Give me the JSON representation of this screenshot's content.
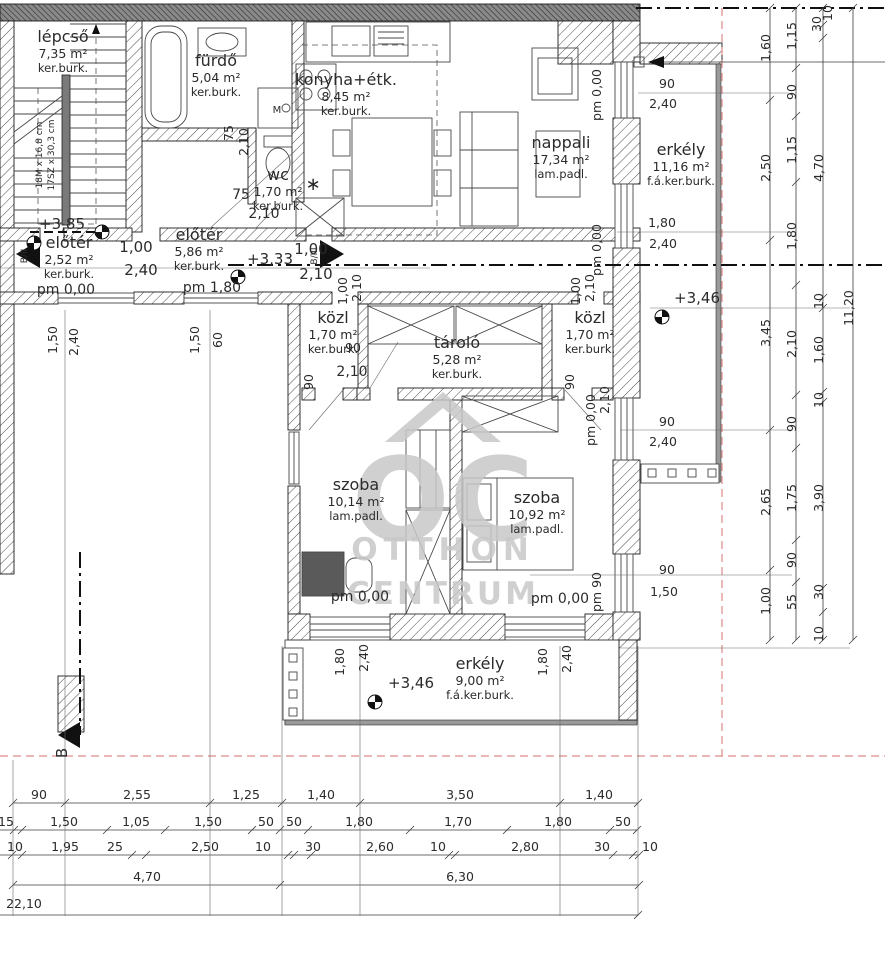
{
  "watermark": {
    "monogram": "OC",
    "line1": "OTTHON",
    "line2": "CENTRUM"
  },
  "section_marks": {
    "bottom": "B",
    "left": "B/II",
    "right": "B/III"
  },
  "stair_note": {
    "risers": "18M x 16,8 cm",
    "treads": "17SZ x 30,3 cm"
  },
  "colors": {
    "wall": "#1b1b1b",
    "hatch": "#4a4a4a",
    "top_band": "#8a8a8a",
    "red_dash": "#dd8a8a",
    "watermark": "#c8c8c8"
  },
  "rooms": [
    {
      "name": "lépcső",
      "area": "7,35 m²",
      "floor": "ker.burk.",
      "x": 63,
      "y": 42
    },
    {
      "name": "fürdő",
      "area": "5,04 m²",
      "floor": "ker.burk.",
      "x": 216,
      "y": 66
    },
    {
      "name": "wc",
      "area": "1,70 m²",
      "floor": "ker.burk.",
      "x": 278,
      "y": 180
    },
    {
      "name": "konyha+étk.",
      "area": "8,45 m²",
      "floor": "ker.burk.",
      "x": 346,
      "y": 85
    },
    {
      "name": "nappali",
      "area": "17,34 m²",
      "floor": "lam.padl.",
      "x": 561,
      "y": 148
    },
    {
      "name": "erkély",
      "area": "11,16 m²",
      "floor": "f.á.ker.burk.",
      "x": 681,
      "y": 155
    },
    {
      "name": "előtér",
      "area": "5,86 m²",
      "floor": "ker.burk.",
      "x": 199,
      "y": 240
    },
    {
      "name": "előtér",
      "area": "2,52 m²",
      "floor": "ker.burk.",
      "x": 69,
      "y": 248
    },
    {
      "name": "közl",
      "area": "1,70 m²",
      "floor": "ker.burk.",
      "x": 333,
      "y": 323
    },
    {
      "name": "tároló",
      "area": "5,28 m²",
      "floor": "ker.burk.",
      "x": 457,
      "y": 348
    },
    {
      "name": "közl",
      "area": "1,70 m²",
      "floor": "ker.burk.",
      "x": 590,
      "y": 323
    },
    {
      "name": "szoba",
      "area": "10,14 m²",
      "floor": "lam.padl.",
      "x": 356,
      "y": 490
    },
    {
      "name": "szoba",
      "area": "10,92 m²",
      "floor": "lam.padl.",
      "x": 537,
      "y": 503
    },
    {
      "name": "erkély",
      "area": "9,00 m²",
      "floor": "f.á.ker.burk.",
      "x": 480,
      "y": 669
    }
  ],
  "dim_labels": [
    {
      "t": "1,60",
      "x": 770,
      "y": 48,
      "r": -90
    },
    {
      "t": "2,50",
      "x": 770,
      "y": 168,
      "r": -90
    },
    {
      "t": "3,45",
      "x": 770,
      "y": 333,
      "r": -90
    },
    {
      "t": "2,65",
      "x": 770,
      "y": 502,
      "r": -90
    },
    {
      "t": "1,00",
      "x": 770,
      "y": 601,
      "r": -90
    },
    {
      "t": "1,15",
      "x": 796,
      "y": 36,
      "r": -90
    },
    {
      "t": "90",
      "x": 796,
      "y": 92,
      "r": -90
    },
    {
      "t": "1,15",
      "x": 796,
      "y": 150,
      "r": -90
    },
    {
      "t": "1,80",
      "x": 796,
      "y": 236,
      "r": -90
    },
    {
      "t": "2,10",
      "x": 796,
      "y": 344,
      "r": -90
    },
    {
      "t": "90",
      "x": 796,
      "y": 424,
      "r": -90
    },
    {
      "t": "1,75",
      "x": 796,
      "y": 498,
      "r": -90
    },
    {
      "t": "90",
      "x": 796,
      "y": 560,
      "r": -90
    },
    {
      "t": "55",
      "x": 796,
      "y": 602,
      "r": -90
    },
    {
      "t": "30",
      "x": 821,
      "y": 24,
      "r": -90
    },
    {
      "t": "10",
      "x": 832,
      "y": 13,
      "r": -90
    },
    {
      "t": "4,70",
      "x": 823,
      "y": 168,
      "r": -90
    },
    {
      "t": "10",
      "x": 823,
      "y": 301,
      "r": -90
    },
    {
      "t": "1,60",
      "x": 823,
      "y": 350,
      "r": -90
    },
    {
      "t": "10",
      "x": 823,
      "y": 400,
      "r": -90
    },
    {
      "t": "3,90",
      "x": 823,
      "y": 498,
      "r": -90
    },
    {
      "t": "30",
      "x": 823,
      "y": 592,
      "r": -90
    },
    {
      "t": "10",
      "x": 823,
      "y": 634,
      "r": -90
    },
    {
      "t": "11,20",
      "x": 853,
      "y": 308,
      "r": -90
    },
    {
      "t": "pm 0,00",
      "x": 601,
      "y": 95,
      "r": -90
    },
    {
      "t": "pm 0,00",
      "x": 601,
      "y": 250,
      "r": -90
    },
    {
      "t": "1,00",
      "x": 580,
      "y": 291,
      "r": -90
    },
    {
      "t": "2,10",
      "x": 594,
      "y": 288,
      "r": -90
    },
    {
      "t": "1,00",
      "x": 347,
      "y": 291,
      "r": -90
    },
    {
      "t": "2,10",
      "x": 361,
      "y": 288,
      "r": -90
    },
    {
      "t": "pm 0,00",
      "x": 595,
      "y": 420,
      "r": -90
    },
    {
      "t": "2,10",
      "x": 609,
      "y": 400,
      "r": -90
    },
    {
      "t": "pm 90",
      "x": 601,
      "y": 592,
      "r": -90
    },
    {
      "t": "75",
      "x": 233,
      "y": 133,
      "r": -90
    },
    {
      "t": "2,10",
      "x": 248,
      "y": 142,
      "r": -90
    },
    {
      "t": "1,50",
      "x": 57,
      "y": 340,
      "r": -90
    },
    {
      "t": "2,40",
      "x": 78,
      "y": 342,
      "r": -90
    },
    {
      "t": "1,50",
      "x": 199,
      "y": 340,
      "r": -90
    },
    {
      "t": "60",
      "x": 222,
      "y": 340,
      "r": -90
    },
    {
      "t": "1,80",
      "x": 344,
      "y": 662,
      "r": -90
    },
    {
      "t": "2,40",
      "x": 368,
      "y": 658,
      "r": -90
    },
    {
      "t": "1,80",
      "x": 547,
      "y": 662,
      "r": -90
    },
    {
      "t": "2,40",
      "x": 571,
      "y": 659,
      "r": -90
    },
    {
      "t": "90",
      "x": 313,
      "y": 382,
      "r": -90
    },
    {
      "t": "90",
      "x": 574,
      "y": 382,
      "r": -90
    },
    {
      "t": "B",
      "x": 67,
      "y": 753,
      "r": -90,
      "s": 15
    },
    {
      "t": "B/II",
      "x": 27,
      "y": 256,
      "r": -90,
      "s": 9
    },
    {
      "t": "B/III",
      "x": 317,
      "y": 256,
      "r": -90,
      "s": 9
    },
    {
      "t": "18M x 16,8 cm",
      "x": 42,
      "y": 155,
      "r": -90,
      "s": 9
    },
    {
      "t": "17SZ x 30,3 cm",
      "x": 54,
      "y": 155,
      "r": -90,
      "s": 9
    },
    {
      "t": "90",
      "x": 667,
      "y": 88
    },
    {
      "t": "2,40",
      "x": 663,
      "y": 108
    },
    {
      "t": "1,80",
      "x": 662,
      "y": 227
    },
    {
      "t": "2,40",
      "x": 663,
      "y": 248
    },
    {
      "t": "90",
      "x": 667,
      "y": 426
    },
    {
      "t": "2,40",
      "x": 663,
      "y": 446
    },
    {
      "t": "90",
      "x": 667,
      "y": 574
    },
    {
      "t": "1,50",
      "x": 664,
      "y": 596
    },
    {
      "t": "+3,46",
      "x": 697,
      "y": 303,
      "s": 15
    },
    {
      "t": "+3,46",
      "x": 411,
      "y": 688,
      "s": 15
    },
    {
      "t": "+3,33",
      "x": 270,
      "y": 264,
      "s": 15
    },
    {
      "t": "+3,85",
      "x": 62,
      "y": 229,
      "s": 15
    },
    {
      "t": "pm 1,80",
      "x": 212,
      "y": 292,
      "s": 14
    },
    {
      "t": "pm 0,00",
      "x": 66,
      "y": 294,
      "s": 14
    },
    {
      "t": "pm 0,00",
      "x": 360,
      "y": 601,
      "s": 14
    },
    {
      "t": "pm 0,00",
      "x": 560,
      "y": 603,
      "s": 14
    },
    {
      "t": "1,00",
      "x": 136,
      "y": 252,
      "s": 15
    },
    {
      "t": "2,40",
      "x": 141,
      "y": 275,
      "s": 15
    },
    {
      "t": "1,00",
      "x": 311,
      "y": 254,
      "s": 15
    },
    {
      "t": "2,10",
      "x": 316,
      "y": 279,
      "s": 15
    },
    {
      "t": "75",
      "x": 241,
      "y": 199,
      "s": 14
    },
    {
      "t": "2,10",
      "x": 264,
      "y": 218,
      "s": 14
    },
    {
      "t": "90",
      "x": 353,
      "y": 352
    },
    {
      "t": "2,10",
      "x": 352,
      "y": 376,
      "s": 14
    },
    {
      "t": "M",
      "x": 277,
      "y": 113,
      "s": 10
    },
    {
      "t": "∗",
      "x": 313,
      "y": 190,
      "s": 18
    },
    {
      "t": "90",
      "x": 39,
      "y": 799
    },
    {
      "t": "2,55",
      "x": 137,
      "y": 799
    },
    {
      "t": "1,25",
      "x": 246,
      "y": 799
    },
    {
      "t": "1,40",
      "x": 321,
      "y": 799
    },
    {
      "t": "3,50",
      "x": 460,
      "y": 799
    },
    {
      "t": "1,40",
      "x": 599,
      "y": 799
    },
    {
      "t": "15",
      "x": 6,
      "y": 826
    },
    {
      "t": "1,50",
      "x": 64,
      "y": 826
    },
    {
      "t": "1,05",
      "x": 136,
      "y": 826
    },
    {
      "t": "1,50",
      "x": 208,
      "y": 826
    },
    {
      "t": "50",
      "x": 266,
      "y": 826
    },
    {
      "t": "50",
      "x": 294,
      "y": 826
    },
    {
      "t": "1,80",
      "x": 359,
      "y": 826
    },
    {
      "t": "1,70",
      "x": 458,
      "y": 826
    },
    {
      "t": "1,80",
      "x": 558,
      "y": 826
    },
    {
      "t": "50",
      "x": 623,
      "y": 826
    },
    {
      "t": "10",
      "x": 15,
      "y": 851
    },
    {
      "t": "1,95",
      "x": 65,
      "y": 851
    },
    {
      "t": "25",
      "x": 115,
      "y": 851
    },
    {
      "t": "2,50",
      "x": 205,
      "y": 851
    },
    {
      "t": "10",
      "x": 263,
      "y": 851
    },
    {
      "t": "30",
      "x": 313,
      "y": 851
    },
    {
      "t": "2,60",
      "x": 380,
      "y": 851
    },
    {
      "t": "10",
      "x": 438,
      "y": 851
    },
    {
      "t": "2,80",
      "x": 525,
      "y": 851
    },
    {
      "t": "30",
      "x": 602,
      "y": 851
    },
    {
      "t": "10",
      "x": 650,
      "y": 851
    },
    {
      "t": "4,70",
      "x": 147,
      "y": 881
    },
    {
      "t": "6,30",
      "x": 460,
      "y": 881
    },
    {
      "t": "22,10",
      "x": 24,
      "y": 908
    }
  ],
  "dims": {
    "vcols": [
      {
        "x": 770,
        "ticks": [
          8,
          100,
          240,
          430,
          570,
          640
        ]
      },
      {
        "x": 796,
        "ticks": [
          8,
          68,
          116,
          182,
          285,
          395,
          448,
          540,
          582,
          640
        ]
      },
      {
        "x": 823,
        "ticks": [
          8,
          25,
          38,
          298,
          308,
          392,
          402,
          588,
          612,
          640
        ]
      },
      {
        "x": 853,
        "ticks": [
          8,
          640
        ]
      }
    ],
    "hrows": [
      {
        "y": 803,
        "x1": 13,
        "x2": 638,
        "ticks": [
          13,
          65,
          210,
          282,
          360,
          560,
          638
        ]
      },
      {
        "y": 830,
        "x1": 0,
        "x2": 637,
        "ticks": [
          14,
          22,
          107,
          165,
          252,
          280,
          308,
          410,
          507,
          610,
          637
        ]
      },
      {
        "y": 855,
        "x1": 0,
        "x2": 639,
        "ticks": [
          12,
          22,
          132,
          146,
          288,
          294,
          311,
          449,
          455,
          613,
          633,
          639
        ]
      },
      {
        "y": 885,
        "x1": 13,
        "x2": 639,
        "ticks": [
          13,
          280,
          639
        ]
      },
      {
        "y": 915,
        "x1": 0,
        "x2": 638,
        "ticks": [
          638
        ]
      }
    ],
    "ext_h": [
      {
        "y": 93,
        "x1": 638,
        "x2": 788
      },
      {
        "y": 232,
        "x1": 617,
        "x2": 788
      },
      {
        "y": 268,
        "x1": 0,
        "x2": 430
      },
      {
        "y": 308,
        "x1": 650,
        "x2": 850
      },
      {
        "y": 430,
        "x1": 620,
        "x2": 792
      },
      {
        "y": 575,
        "x1": 530,
        "x2": 792
      },
      {
        "y": 648,
        "x1": 620,
        "x2": 850
      }
    ],
    "proj_v": [
      {
        "x": 13,
        "y1": 760,
        "y2": 916
      },
      {
        "x": 65,
        "y1": 310,
        "y2": 916
      },
      {
        "x": 210,
        "y1": 310,
        "y2": 916
      },
      {
        "x": 282,
        "y1": 646,
        "y2": 916
      },
      {
        "x": 360,
        "y1": 646,
        "y2": 916
      },
      {
        "x": 560,
        "y1": 646,
        "y2": 916
      },
      {
        "x": 638,
        "y1": 646,
        "y2": 916
      }
    ]
  }
}
